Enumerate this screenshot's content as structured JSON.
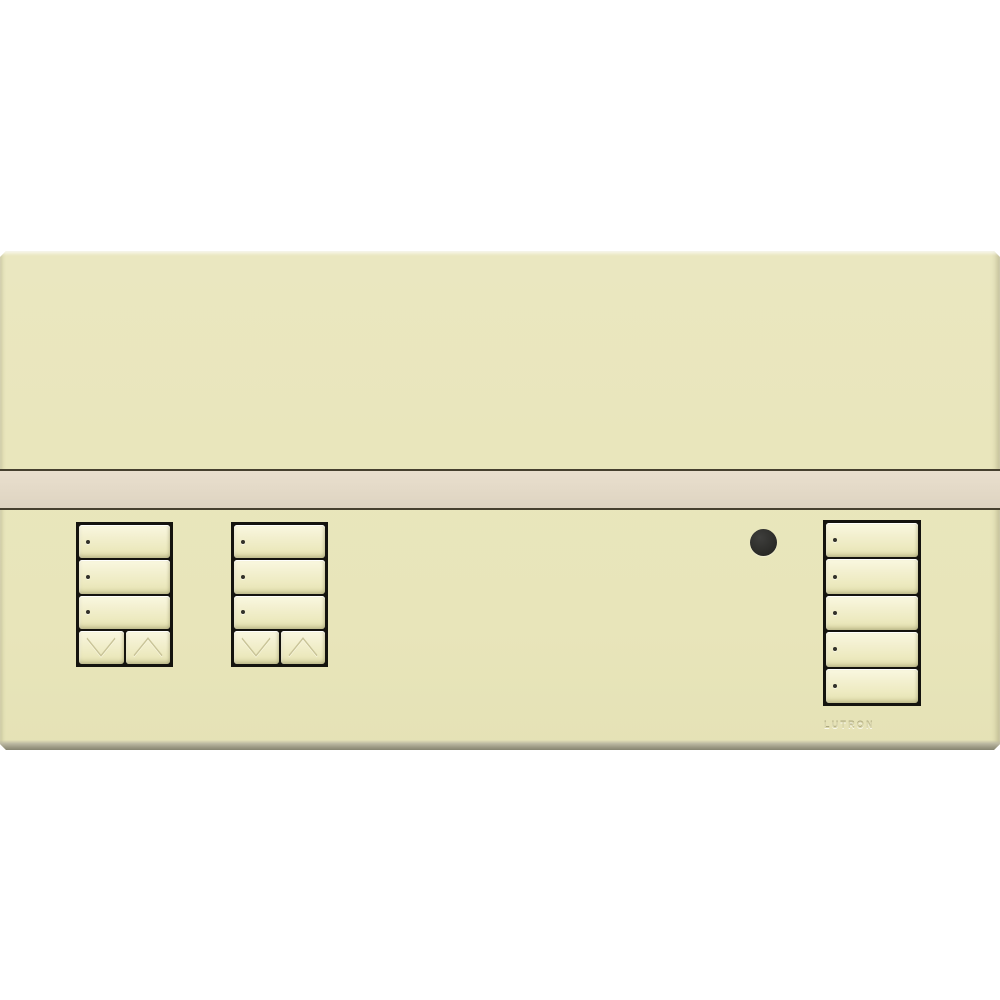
{
  "brand_label": "LUTRON",
  "device": {
    "kind": "wall-mounted lighting control keypad faceplate",
    "finish": "almond",
    "colors": {
      "background": "#ffffff",
      "faceplate": "#e9e6bc",
      "accent_band": "#e4dac8",
      "band_border": "#46402f",
      "keypad_frame": "#14130e",
      "button_face": "#f3f0d0",
      "led_dot": "#32312a",
      "ir_sensor": "#2b2b28",
      "brand_text": "#d9d5a9"
    }
  },
  "keypads": [
    {
      "id": "keypad-left-1",
      "large_buttons": 3,
      "leds_per_button": 1,
      "has_raise_lower": true,
      "raise_lower": [
        {
          "icon": "chevron-down-icon",
          "action": "lower"
        },
        {
          "icon": "chevron-up-icon",
          "action": "raise"
        }
      ]
    },
    {
      "id": "keypad-left-2",
      "large_buttons": 3,
      "leds_per_button": 1,
      "has_raise_lower": true,
      "raise_lower": [
        {
          "icon": "chevron-down-icon",
          "action": "lower"
        },
        {
          "icon": "chevron-up-icon",
          "action": "raise"
        }
      ]
    },
    {
      "id": "keypad-right",
      "large_buttons": 5,
      "leds_per_button": 1,
      "has_raise_lower": false,
      "raise_lower": []
    }
  ],
  "ir_sensor": {
    "present": true
  }
}
